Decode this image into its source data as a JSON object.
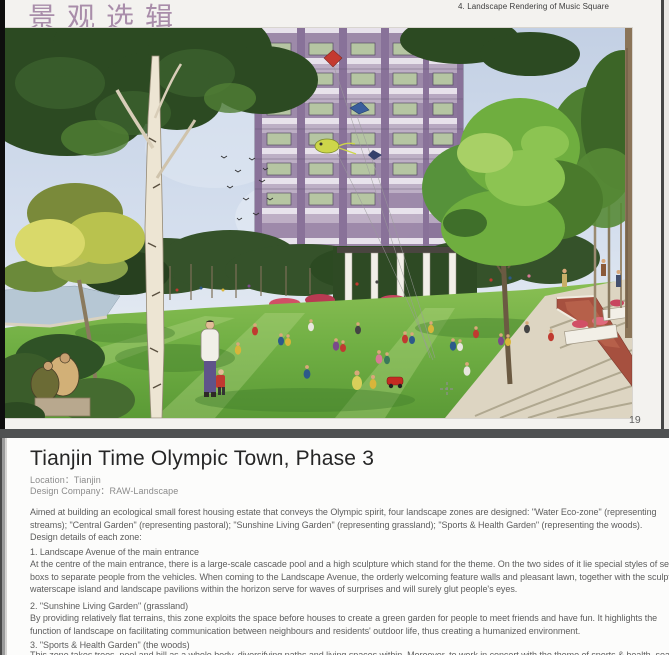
{
  "photo_page": {
    "series_title": "景观选辑",
    "figure_caption": "4. Landscape Rendering of Music Square",
    "page_number": "19"
  },
  "illustration": {
    "description": "Watercolor landscape rendering of a residential music-square park: wide green lawn with groups of people sitting, kites flying, a white birch and dense green trees, red flower beds, stone steps, a red brick path, and a purple high-rise apartment building behind",
    "palette": {
      "sky": "#c9d5e7",
      "lawn": "#73b043",
      "building_facade": "#9b87a7",
      "flowers": "#d64f66",
      "brick_path": "#a6503f",
      "foliage_dark": "#2c4a22",
      "foliage_light": "#8cc452",
      "birch_trunk": "#ede5d3"
    }
  },
  "article_page": {
    "title": "Tianjin Time Olympic Town, Phase 3",
    "location_line": "Location：Tianjin",
    "company_line": "Design Company：RAW-Landscape",
    "body_lines": [
      "Aimed at building an ecological small forest housing estate that conveys the Olympic spirit, four landscape zones are designed: \"Water Eco-zone\" (representing",
      "streams); \"Central Garden\" (representing pastoral); \"Sunshine Living Garden\" (representing grassland); \"Sports & Health Garden\" (representing the woods).",
      "Design details of each zone:",
      "1. Landscape Avenue of the main entrance",
      "At the centre of the main entrance, there is a large-scale cascade pool and a high sculpture which stand for the theme. On the two sides of it lie special styles of sentry",
      "boxs to separate people from the vehicles. When coming to the Landscape Avenue, the orderly welcoming feature walls and pleasant lawn, together with the sculpture",
      "waterscape island and landscape pavilions within the horizon serve for waves of surprises and will surely glut people's eyes.",
      "2. \"Sunshine Living Garden\" (grassland)",
      "By providing relatively flat terrains, this zone exploits the space before houses to create a green garden for people to meet friends and have fun. It highlights the",
      "function of landscape on facilitating communication between neighbours and residents' outdoor life, thus creating a humanized environment.",
      "3. \"Sports & Health Garden\" (the woods)",
      "This zone takes trees, pool and hill as a whole body, diversifying paths and living spaces within. Moreover, to work in concert with the theme of sports & health, seasons"
    ]
  }
}
